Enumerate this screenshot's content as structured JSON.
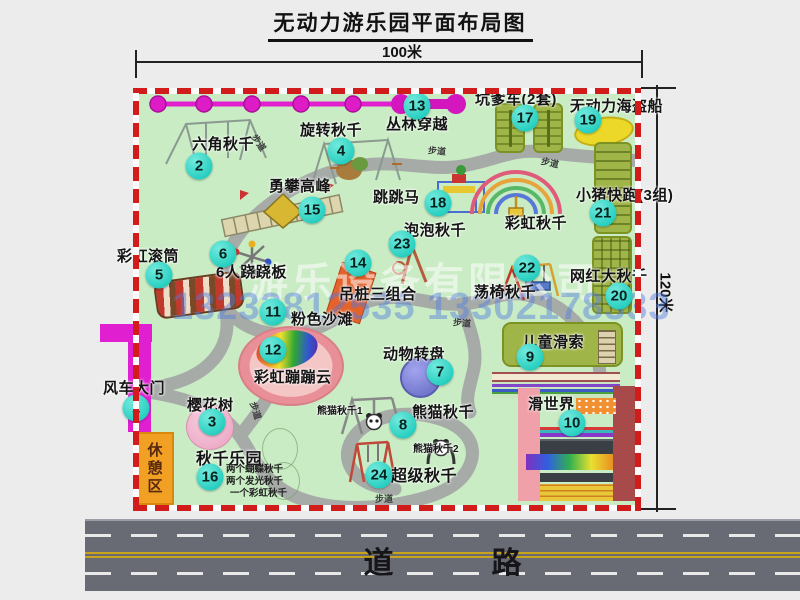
{
  "title": "无动力游乐园平面布局图",
  "dimensions": {
    "width_label": "100米",
    "height_label": "120米"
  },
  "road_label": "道　路",
  "watermark": {
    "company": "游乐设备有限公司",
    "phone": "13233812535 13302178333"
  },
  "labels": {
    "path": "步道",
    "rest_area": "休憩区",
    "rainbow_swing": "彩虹秋千",
    "panda1": "熊猫秋千1",
    "panda2": "熊猫秋千2",
    "swing_park_items": [
      "两个蝴蝶秋千",
      "两个发光秋千",
      "一个彩虹秋千"
    ]
  },
  "attractions": [
    {
      "num": "1",
      "name": "风车大门"
    },
    {
      "num": "2",
      "name": "六角秋千"
    },
    {
      "num": "3",
      "name": "樱花树"
    },
    {
      "num": "4",
      "name": "旋转秋千"
    },
    {
      "num": "5",
      "name": "彩虹滚筒"
    },
    {
      "num": "6",
      "name": "6人跷跷板"
    },
    {
      "num": "7",
      "name": "动物转盘"
    },
    {
      "num": "8",
      "name": "熊猫秋千"
    },
    {
      "num": "9",
      "name": "儿童滑索"
    },
    {
      "num": "10",
      "name": "滑世界"
    },
    {
      "num": "11",
      "name": "粉色沙滩"
    },
    {
      "num": "12",
      "name": "彩虹蹦蹦云"
    },
    {
      "num": "13",
      "name": "丛林穿越"
    },
    {
      "num": "14",
      "name": "吊桩三组合"
    },
    {
      "num": "15",
      "name": "勇攀高峰"
    },
    {
      "num": "16",
      "name": "秋千乐园"
    },
    {
      "num": "17",
      "name": "坑爹车(2套)"
    },
    {
      "num": "18",
      "name": "跳跳马"
    },
    {
      "num": "19",
      "name": "无动力海盗船"
    },
    {
      "num": "20",
      "name": "网红大秋千"
    },
    {
      "num": "21",
      "name": "小猪快跑(3组)"
    },
    {
      "num": "22",
      "name": "荡椅秋千"
    },
    {
      "num": "23",
      "name": "泡泡秋千"
    },
    {
      "num": "24",
      "name": "超级秋千"
    }
  ]
}
